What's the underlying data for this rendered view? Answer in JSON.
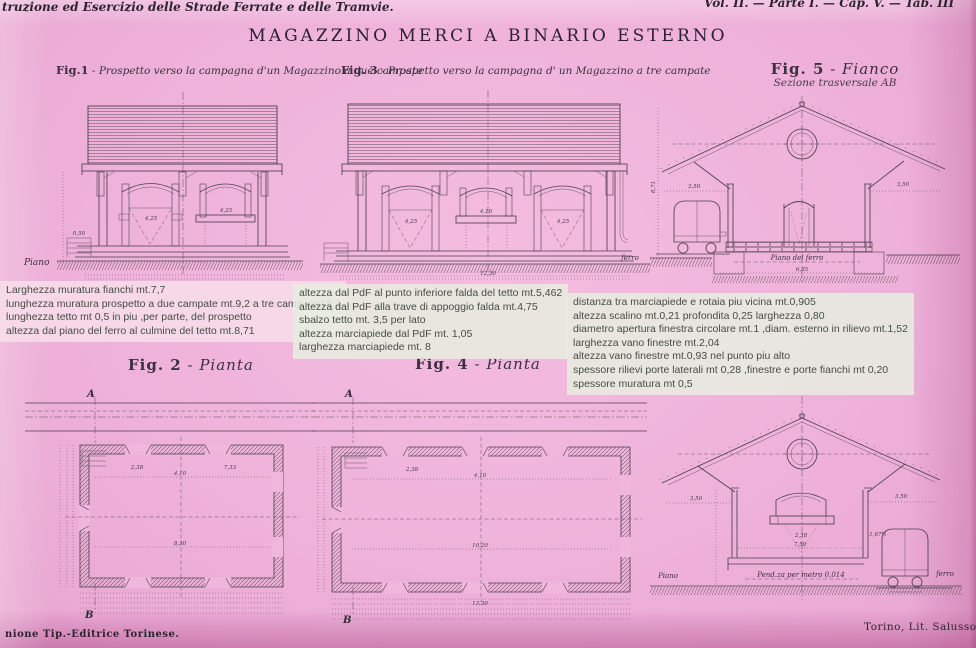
{
  "header": {
    "left": "truzione ed Esercizio delle Strade Ferrate e delle Tramvie.",
    "right": "Vol. II. — Parte I. — Cap. V. — Tab. III"
  },
  "title": "MAGAZZINO MERCI A BINARIO ESTERNO",
  "captions": {
    "fig1": {
      "id": "Fig.1",
      "text": " - Prospetto verso la campagna d'un Magazzino a due campate"
    },
    "fig3": {
      "id": "Fig. 3",
      "text": " - Prospetto verso la campagna d' un Magazzino a tre campate"
    },
    "fig5": {
      "id": "Fig. 5",
      "text": " - Fianco",
      "sub": "Sezione trasversale AB"
    },
    "fig2": {
      "id": "Fig. 2",
      "text": " - Pianta"
    },
    "fig4": {
      "id": "Fig. 4",
      "text": " - Pianta"
    }
  },
  "notes": {
    "left": {
      "lines": [
        "Larghezza muratura fianchi mt.7,7",
        "lunghezza muratura prospetto a due campate mt.9,2 a tre camp. mt13,3",
        "lunghezza tetto mt 0,5 in piu ,per parte, del prospetto",
        "altezza dal piano del ferro al culmine del tetto mt.8,71"
      ]
    },
    "middle": {
      "lines": [
        "altezza dal PdF al punto inferiore falda del tetto mt.5,462",
        "altezza dal PdF alla trave di appoggio falda mt.4,75",
        "sbalzo tetto mt. 3,5 per lato",
        "altezza marciapiede dal PdF mt. 1,05",
        "larghezza marciapiede mt. 8"
      ]
    },
    "right": {
      "lines": [
        "distanza tra marciapiede e rotaia piu vicina mt.0,905",
        "altezza scalino mt.0,21 profondita 0,25 larghezza 0,80",
        "diametro apertura finestra circolare mt.1 ,diam. esterno in rilievo mt.1,52",
        "larghezza vano finestre mt.2,04",
        "altezza vano finestre mt.0,93 nel punto piu alto",
        "spessore rilievi porte laterali mt 0,28 ,finestre e porte fianchi mt 0,20",
        "spessore muratura mt 0,5"
      ]
    }
  },
  "drawings": {
    "fig1": {
      "dims": [
        "4,25",
        "4,25",
        "0,50"
      ],
      "ground_label": "Piano"
    },
    "fig3": {
      "dims": [
        "4,25",
        "4,10",
        "4,25",
        "12,30"
      ],
      "ground_label": "ferro"
    },
    "fig5": {
      "dims": [
        "3,50",
        "3,50",
        "8,71",
        "6,85"
      ],
      "baseline": "Piano del ferro"
    },
    "fig2": {
      "section_top": "A",
      "section_bottom": "B",
      "dims": [
        "2,38",
        "4,10",
        "8,30",
        "7,33"
      ]
    },
    "fig4": {
      "section_top": "A",
      "section_bottom": "B",
      "dims": [
        "2,38",
        "4,10",
        "10,20",
        "13,30"
      ]
    },
    "fig6": {
      "dims": [
        "3,50",
        "3,50",
        "2,38",
        "1,67½",
        "7,50"
      ],
      "slope": "Pend.za per metro 0,014",
      "left_label": "Piano",
      "right_label": "ferro"
    }
  },
  "footer": {
    "left": "nione Tip.-Editrice Torinese.",
    "right": "Torino, Lit. Salussolia"
  }
}
